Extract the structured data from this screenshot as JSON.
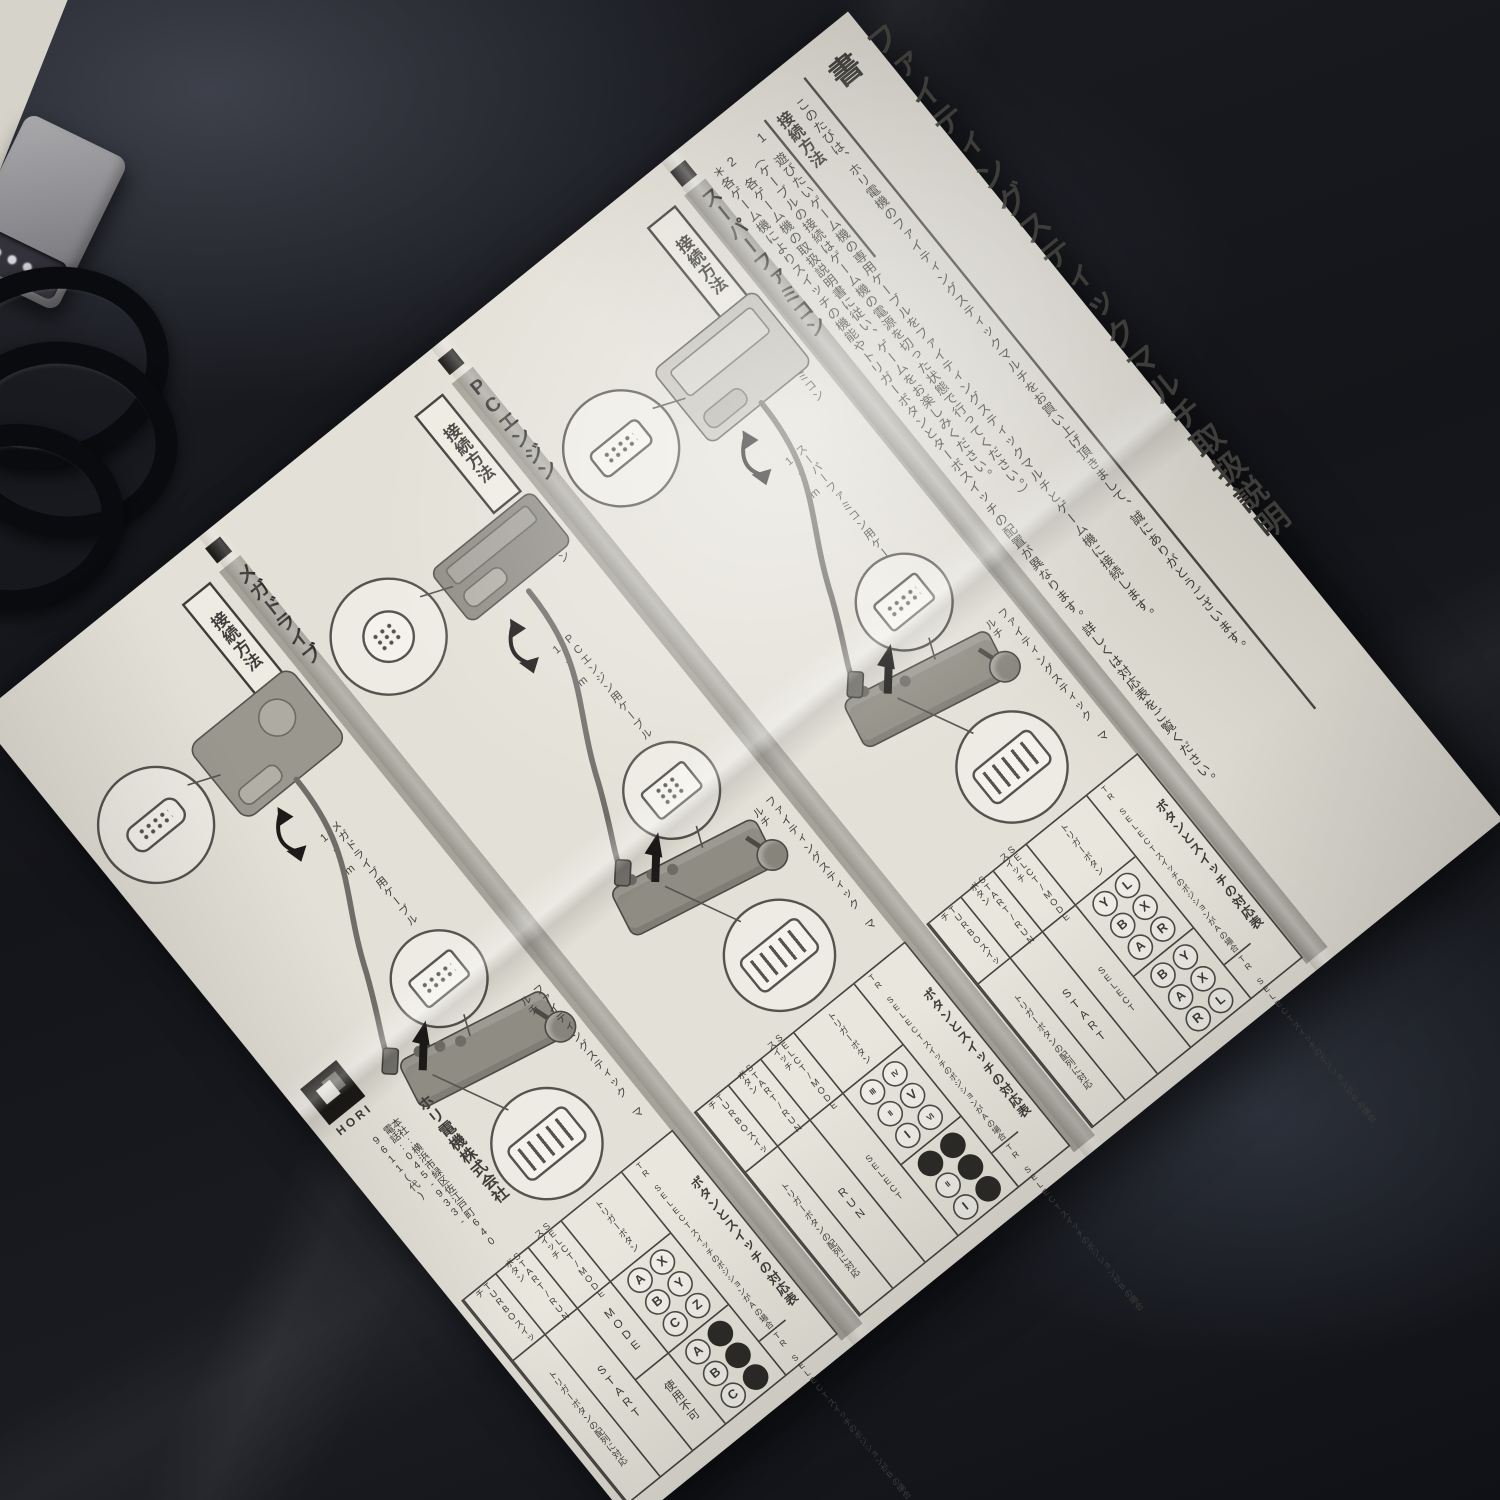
{
  "scene": {
    "background": "dark navy fabric",
    "objects": {
      "connector": "game controller connector",
      "cable": "coiled controller cable"
    },
    "colors": {
      "paper": "#e3e0d7",
      "fabric": "#14151a",
      "bar_gray": "#a5a299",
      "ink": "#3e3d39"
    }
  },
  "manual": {
    "title": "ファイティングスティックマルチ取扱説明書",
    "greeting": "このたびは、ホリ電機のファイティングスティックマルチをお買い上げ頂きまして、誠にありがとうございます。",
    "howto_heading": "接続方法",
    "step1": "1　遊びたいゲーム機の専用ケーブルをファイティングスティックマルチとゲーム機に接続します。",
    "step1_note": "（ケーブルの接続はゲーム機の電源を切った状態で行ってください。）",
    "step2": "2　各ゲーム機の取扱説明書に従い、ゲームをお楽しみください。",
    "note": "＊各ゲーム機によりスイッチの機能やトリガーボタンとターボスイッチの配置が異なります。詳しくは対応表をご覧ください。",
    "connect_label": "接続方法",
    "stick_label": "ファイティングスティック マルチ",
    "sections": [
      {
        "name": "スーパーファミコン",
        "console_label": "スーパーファミコン",
        "cable_label": "スーパーファミコン用ケーブル 約1.7m",
        "table": {
          "title": "ボタンとスイッチの対応表",
          "case_a": "TR SELECTスイッチのポジションがAの場合",
          "case_b": "TR SELECTスイッチのポジションがBの場合",
          "columns": [
            "トリガーボタン",
            "SELCT/MODEスイッチ",
            "START/RUNボタン",
            "TURBOスイッチ"
          ],
          "trigger_a": {
            "top": [
              "L",
              "X",
              "R"
            ],
            "bottom": [
              "Y",
              "B",
              "A"
            ]
          },
          "trigger_b": {
            "top": [
              "Y",
              "X",
              "L"
            ],
            "bottom": [
              "B",
              "A",
              "R"
            ]
          },
          "select_mode": [
            "SELECT"
          ],
          "start_run": [
            "START"
          ],
          "turbo": [
            "トリガーボタンの配列に対応"
          ]
        }
      },
      {
        "name": "PCエンジン",
        "console_label": "PCエンジン",
        "cable_label": "PCエンジン用ケーブル 約1.7m",
        "table": {
          "title": "ボタンとスイッチの対応表",
          "case_a": "TR SELECTスイッチのポジションがAの場合",
          "case_b": "TR SELECTスイッチのポジションがBの場合",
          "columns": [
            "トリガーボタン",
            "SELCT/MODEスイッチ",
            "START/RUNボタン",
            "TURBOスイッチ"
          ],
          "trigger_a": {
            "top": [
              "IV",
              "V",
              "VI"
            ],
            "bottom": [
              "III",
              "II",
              "I"
            ]
          },
          "trigger_b": {
            "top": [
              "●",
              "●",
              "●"
            ],
            "bottom": [
              "●",
              "II",
              "I"
            ]
          },
          "select_mode": [
            "SELECT"
          ],
          "start_run": [
            "RUN"
          ],
          "turbo": [
            "トリガーボタンの配列に対応"
          ]
        }
      },
      {
        "name": "メガドライブ",
        "console_label": "メガドライブ",
        "cable_label": "メガドライブ用ケーブル 約1.7m",
        "table": {
          "title": "ボタンとスイッチの対応表",
          "case_a": "TR SELECTスイッチのポジションがAの場合",
          "case_b": "TR SELECTスイッチのポジションがBの場合",
          "columns": [
            "トリガーボタン",
            "SELCT/MODEスイッチ",
            "START/RUNボタン",
            "TURBOスイッチ"
          ],
          "trigger_a": {
            "top": [
              "X",
              "Y",
              "Z"
            ],
            "bottom": [
              "A",
              "B",
              "C"
            ]
          },
          "trigger_b": {
            "top": [
              "●",
              "●",
              "●"
            ],
            "bottom": [
              "A",
              "B",
              "C"
            ]
          },
          "select_mode": [
            "MODE",
            "使用不可"
          ],
          "start_run": [
            "START"
          ],
          "turbo": [
            "トリガーボタンの配列に対応"
          ]
        }
      }
    ],
    "publisher": {
      "logo_text": "HORI",
      "company": "ホリ電機株式会社",
      "address": "本社:横浜市緑区佐江戸町640",
      "phone": "電話:045-933-9611(代)"
    }
  }
}
